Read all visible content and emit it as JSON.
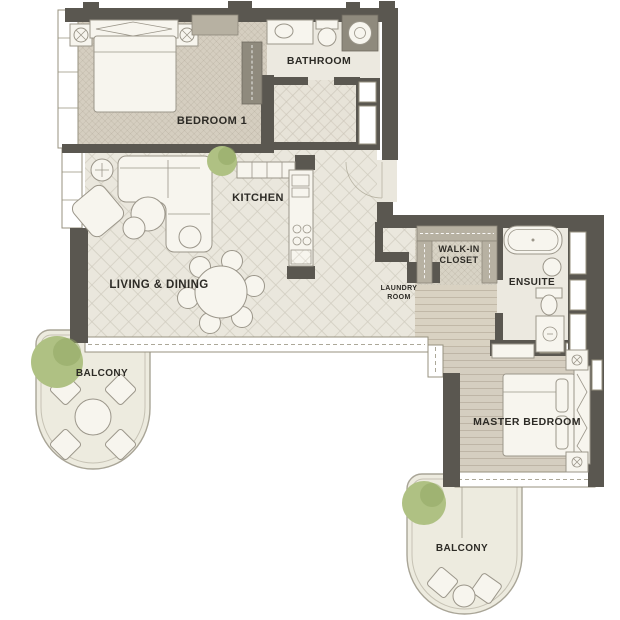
{
  "colors": {
    "wall": "#5a5750",
    "window_stroke": "#97927f",
    "floor_tan": "#d5cec0",
    "floor_tile": "#eae7dd",
    "floor_light": "#ece9e0",
    "closet_floor": "#d8d3c5",
    "corridor_floor": "#d9d2c2",
    "balcony_fill": "#edebdf",
    "balcony_stroke": "#a9a597",
    "furniture_fill": "#f7f5ee",
    "furniture_stroke": "#9b968a",
    "wardrobe_gray": "#b7b1a2",
    "appliance_dark": "#8f8a7d",
    "tree_green": "#afc183",
    "tree_green_dark": "#8fa562",
    "label": "#2d2b26"
  },
  "labels": {
    "bathroom": "BATHROOM",
    "bedroom1": "BEDROOM 1",
    "kitchen": "KITCHEN",
    "living_dining": "LIVING & DINING",
    "balcony_left": "BALCONY",
    "laundry_line1": "LAUNDRY",
    "laundry_line2": "ROOM",
    "walkin_line1": "WALK-IN",
    "walkin_line2": "CLOSET",
    "ensuite": "ENSUITE",
    "master_bedroom": "MASTER BEDROOM",
    "balcony_bottom": "BALCONY"
  }
}
